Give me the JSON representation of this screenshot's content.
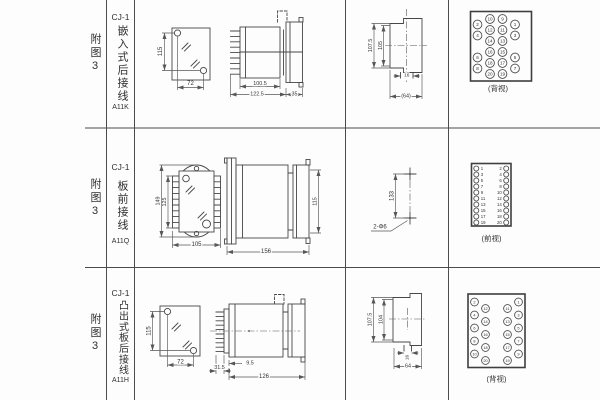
{
  "colors": {
    "line": "#474747",
    "text": "#2f2f2f",
    "bg": "#fdfdfd"
  },
  "rows": [
    {
      "fig": "附图3",
      "model": "CJ-1",
      "mount": "嵌入式后接线",
      "code": "A11K",
      "dims": {
        "d115": "115",
        "d72": "72",
        "d100_5": "100.5",
        "d122_5": "122.5",
        "d35": "35",
        "d107_5": "107.5",
        "d105": "105",
        "d16": "16",
        "d64": "(64)"
      }
    },
    {
      "fig": "附图3",
      "model": "CJ-1",
      "mount": "板前接线",
      "code": "A11Q",
      "dims": {
        "d149": "149",
        "d125": "125",
        "d105": "105",
        "d156": "156",
        "d115": "115",
        "d133": "133",
        "holes": "2-Φ6"
      }
    },
    {
      "fig": "附图3",
      "model": "CJ-1",
      "mount": "凸出式板后接线",
      "code": "A11H",
      "dims": {
        "d115": "115",
        "d72": "72",
        "d31_5": "31.5",
        "d9_5": "9.5",
        "d126": "126",
        "d107_5": "107.5",
        "d104": "104",
        "d16": "16",
        "d64": "64"
      }
    }
  ],
  "terminal_blocks": [
    {
      "view_label": "(背视)",
      "inner_left": [
        10,
        12,
        14,
        16,
        18,
        20
      ],
      "inner_right": [
        9,
        11,
        13,
        15,
        17,
        19
      ],
      "outer_left": [
        2,
        4,
        6,
        8
      ],
      "outer_right": [
        1,
        3,
        5,
        7
      ]
    },
    {
      "view_label": "(前视)",
      "left": [
        1,
        3,
        5,
        7,
        9,
        11,
        13,
        15,
        17,
        19
      ],
      "right": [
        2,
        4,
        6,
        8,
        10,
        12,
        14,
        16,
        18,
        20
      ]
    },
    {
      "view_label": "(背视)",
      "outer_left": [
        2,
        4,
        6,
        8,
        10
      ],
      "inner_left": [
        12,
        14,
        16,
        18,
        20
      ],
      "inner_right": [
        11,
        13,
        15,
        17,
        19
      ],
      "outer_right": [
        1,
        3,
        5,
        7,
        9
      ]
    }
  ]
}
